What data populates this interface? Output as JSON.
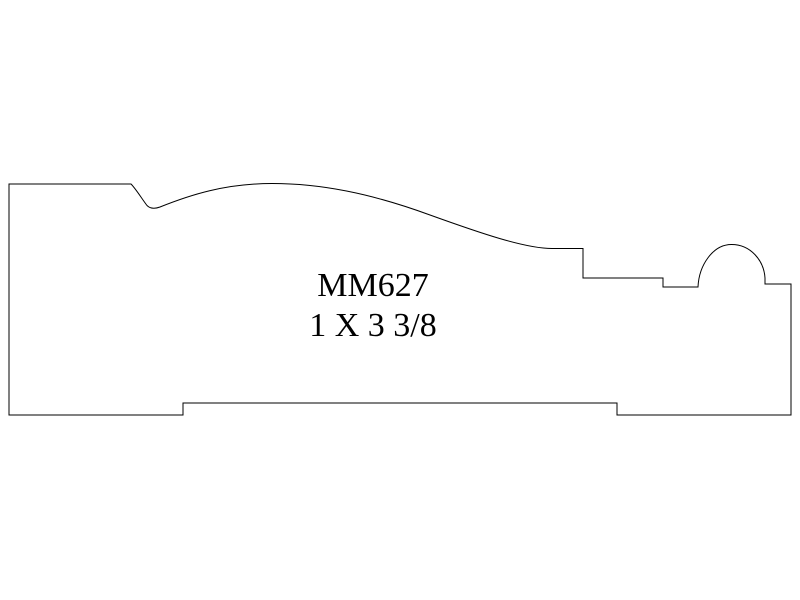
{
  "drawing": {
    "part_number": "MM627",
    "size": "1 X 3 3/8",
    "line_color": "#000000",
    "background_color": "#ffffff",
    "profile_path": "M 9 184 L 131 184 C 136 189 142 199 147 205.5 C 150 208.5 154 209.2 160 207 C 190 195 225 183.5 272 183.5 C 320 183.5 370 193 430 215 C 480 233 525 248.5 552 248.5 L 583 248.5 L 583 278 L 663 278 L 663 287 L 698 287 C 699 265 713 244.5 731.5 244.5 C 751 244.5 764 261 765 278 L 765 284 L 791 284 L 791 415 L 617 415 L 617 403 L 183 403 L 183 415 L 9 415 Z"
  }
}
